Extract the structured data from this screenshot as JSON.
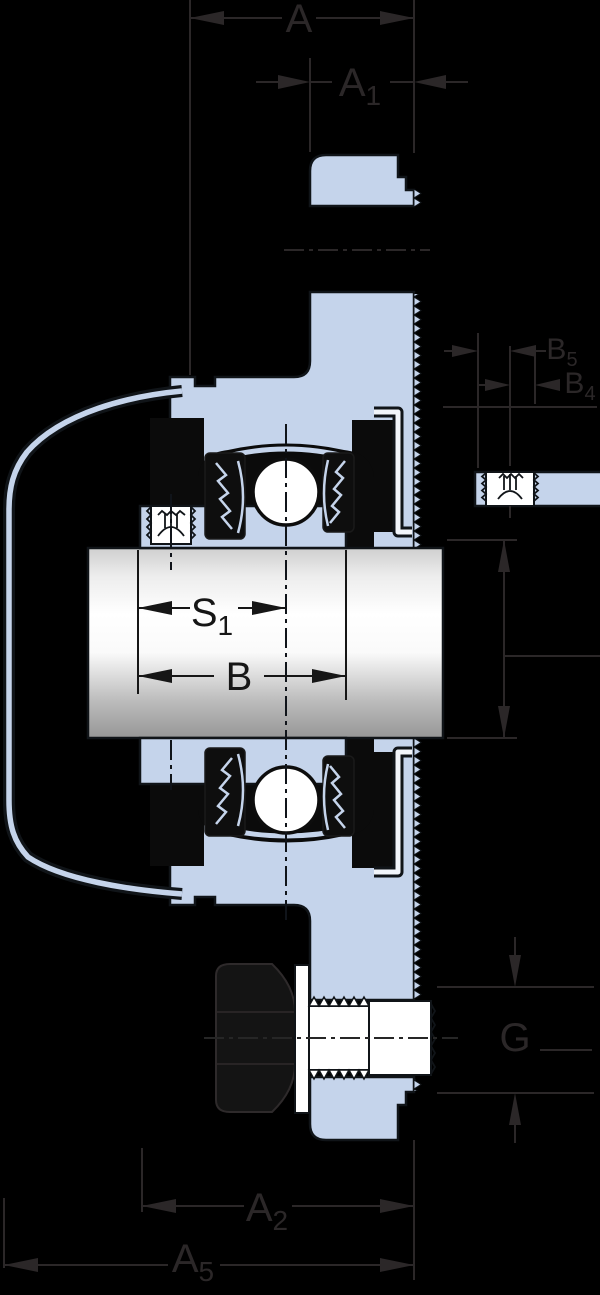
{
  "figure": {
    "kind": "technical-drawing",
    "subject": "flanged bearing unit cross-section with shaft, set screws and mounting bolt"
  },
  "colors": {
    "background": "#000000",
    "part_fill": "#c5d4eb",
    "outline": "#101418",
    "dimension_gray": "#2b2728",
    "dimension_black": "#161616",
    "white": "#ffffff"
  },
  "dims": {
    "overall_width": {
      "main": "A",
      "sub": ""
    },
    "flange_width": {
      "main": "A",
      "sub": "1"
    },
    "ring_offset": {
      "main": "S",
      "sub": "1"
    },
    "ring_width": {
      "main": "B",
      "sub": ""
    },
    "collar_width": {
      "main": "B",
      "sub": "5"
    },
    "screw_offset": {
      "main": "B",
      "sub": "4"
    },
    "bolt_size": {
      "main": "G",
      "sub": ""
    },
    "mount_width": {
      "main": "A",
      "sub": "2"
    },
    "total_width": {
      "main": "A",
      "sub": "5"
    }
  }
}
